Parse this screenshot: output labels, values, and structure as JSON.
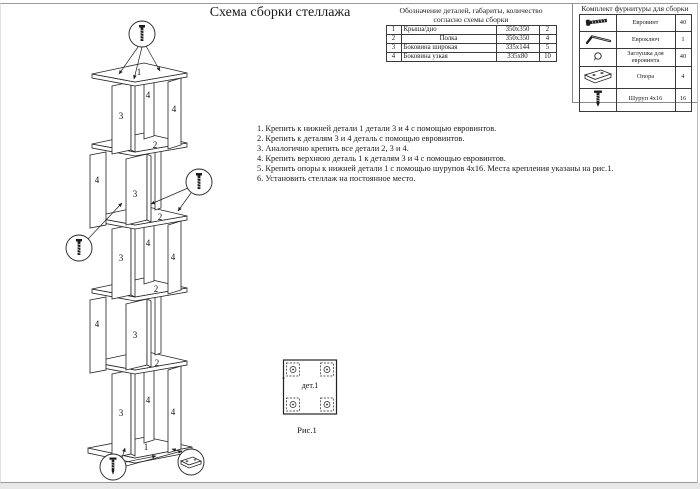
{
  "page": {
    "title": "Схема сборки стеллажа"
  },
  "parts_table": {
    "title_line1": "Обозначение деталей, габариты, количество",
    "title_line2": "согласно схемы сборки",
    "rows": [
      [
        "1",
        "Крыша/дно",
        "350x350",
        "2"
      ],
      [
        "2",
        "Полка",
        "350x350",
        "4"
      ],
      [
        "3",
        "Боковина широкая",
        "335x144",
        "5"
      ],
      [
        "4",
        "Боковина узкая",
        "335x80",
        "10"
      ]
    ]
  },
  "hardware": {
    "title": "Комплект фурнитуры для сборки",
    "rows": [
      {
        "icon": "euroscrew-icon",
        "name": "Евровинт",
        "qty": "40"
      },
      {
        "icon": "eurokey-icon",
        "name": "Евроключ",
        "qty": "1"
      },
      {
        "icon": "cap-icon",
        "name": "Заглушка для евровинта",
        "qty": "40"
      },
      {
        "icon": "support-icon",
        "name": "Опора",
        "qty": "4"
      },
      {
        "icon": "screw-icon",
        "name": "Шуруп 4x16",
        "qty": "16"
      }
    ]
  },
  "instructions": [
    "1. Крепить к нижней детали 1 детали 3 и 4 с помощью евровинтов.",
    "2. Крепить к деталям 3 и 4 деталь с помощью евровинтов.",
    "3. Аналогично крепить все детали 2, 3 и 4.",
    "4. Крепить верхнюю деталь 1 к деталям 3 и 4 с помощью евровинтов.",
    "5. Крепить опоры к нижней детали 1 с помощью шурупов 4x16. Места крепления указаны на рис.1.",
    "6. Установить стеллаж на постоянное место."
  ],
  "figure": {
    "label": "дет.1",
    "caption": "Рис.1"
  },
  "diagram": {
    "labels": {
      "top": "1",
      "bottom": "1",
      "shelf": "2",
      "side_wide": "3",
      "side_narrow": "4"
    },
    "colors": {
      "line": "#222222",
      "text": "#111111"
    }
  }
}
